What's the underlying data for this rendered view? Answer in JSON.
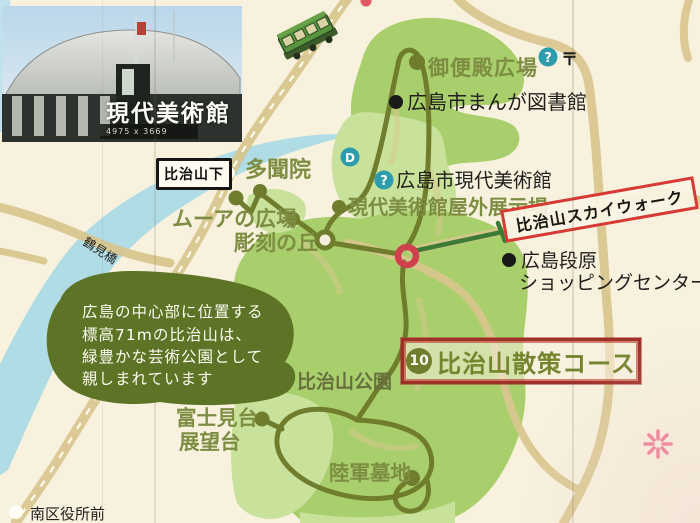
{
  "photo": {
    "label": "現代美術館",
    "caption": "4975 x 3669"
  },
  "info_blob": {
    "line1": "広島の中心部に位置する",
    "line2": "標高71mの比治山は、",
    "line3": "緑豊かな芸術公園として",
    "line4": "親しまれています"
  },
  "course_title": {
    "number": "10",
    "label": "比治山散策コース"
  },
  "skywalk_label": "比治山スカイウォーク",
  "stops": {
    "hijiyamashita": "比治山下",
    "minamikuyakushomae": "南区役所前"
  },
  "places": {
    "gobenden_hiroba": "御便殿広場",
    "manga_library": "広島市まんが図書館",
    "tamonin": "多聞院",
    "moore_hiroba": "ムーアの広場",
    "museum_contemporary": "広島市現代美術館",
    "outdoor_exhibition": "現代美術館屋外展示場",
    "sculpture_hill": "彫刻の丘",
    "danbara_line1": "広島段原",
    "danbara_line2": "ショッピングセンター",
    "hijiyama_park": "比治山公園",
    "fujimidai_line1": "富士見台",
    "fujimidai_line2": "展望台",
    "army_cemetery": "陸軍墓地",
    "tsurumi_bridge": "鶴見橋"
  },
  "icons": {
    "question_mark": "?",
    "post_office": "〒",
    "d_mark": "D"
  },
  "colors": {
    "background_cream": "#f7f1de",
    "park_green": "#a9cf6c",
    "park_light_green": "#c8e29c",
    "route_olive": "#6f7d2c",
    "label_olive": "#7d8d42",
    "road_tan": "#d9c68e",
    "river_blue": "#a6d9e6",
    "skywalk_red": "#d63a33",
    "title_red": "#9e3028",
    "marker_red_ring": "#cf414d",
    "teal_icon": "#2d9cab",
    "info_blob_green": "#5d7426",
    "flower_pink": "#ee7590"
  }
}
